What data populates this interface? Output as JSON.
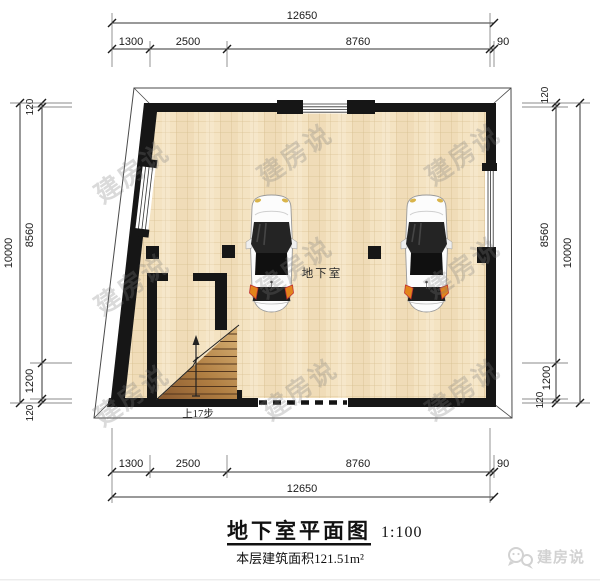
{
  "dimensions": {
    "top": {
      "total": "12650",
      "segments": [
        "1300",
        "2500",
        "8760",
        "90"
      ]
    },
    "bottom": {
      "total": "12650",
      "segments": [
        "1300",
        "2500",
        "8760",
        "90"
      ]
    },
    "left": {
      "total": "10000",
      "segments": [
        "120",
        "8560",
        "1200",
        "120"
      ]
    },
    "right": {
      "total": "10000",
      "segments": [
        "120",
        "8560",
        "1200",
        "120"
      ]
    }
  },
  "plan": {
    "room_label": "地下室",
    "stairs_label": "上17步"
  },
  "title_block": {
    "title": "地下室平面图",
    "scale": "1:100",
    "area_note": "本层建筑面积121.51m²"
  },
  "watermark": {
    "text": "建房说"
  },
  "logo": {
    "text": "建房说"
  },
  "colors": {
    "wall": "#161616",
    "floor_tile": "#f4e3c2",
    "tile_grid": "#d9c294",
    "stair_wood_light": "#d8b276",
    "stair_wood_dark": "#8a5a30",
    "car_glass": "#1e1e1e",
    "tail_light_orange": "#e2841c",
    "tail_light_red": "#c03030",
    "watermark_gray": "#7c7c7c",
    "logo_gray": "#d2d2d2"
  }
}
